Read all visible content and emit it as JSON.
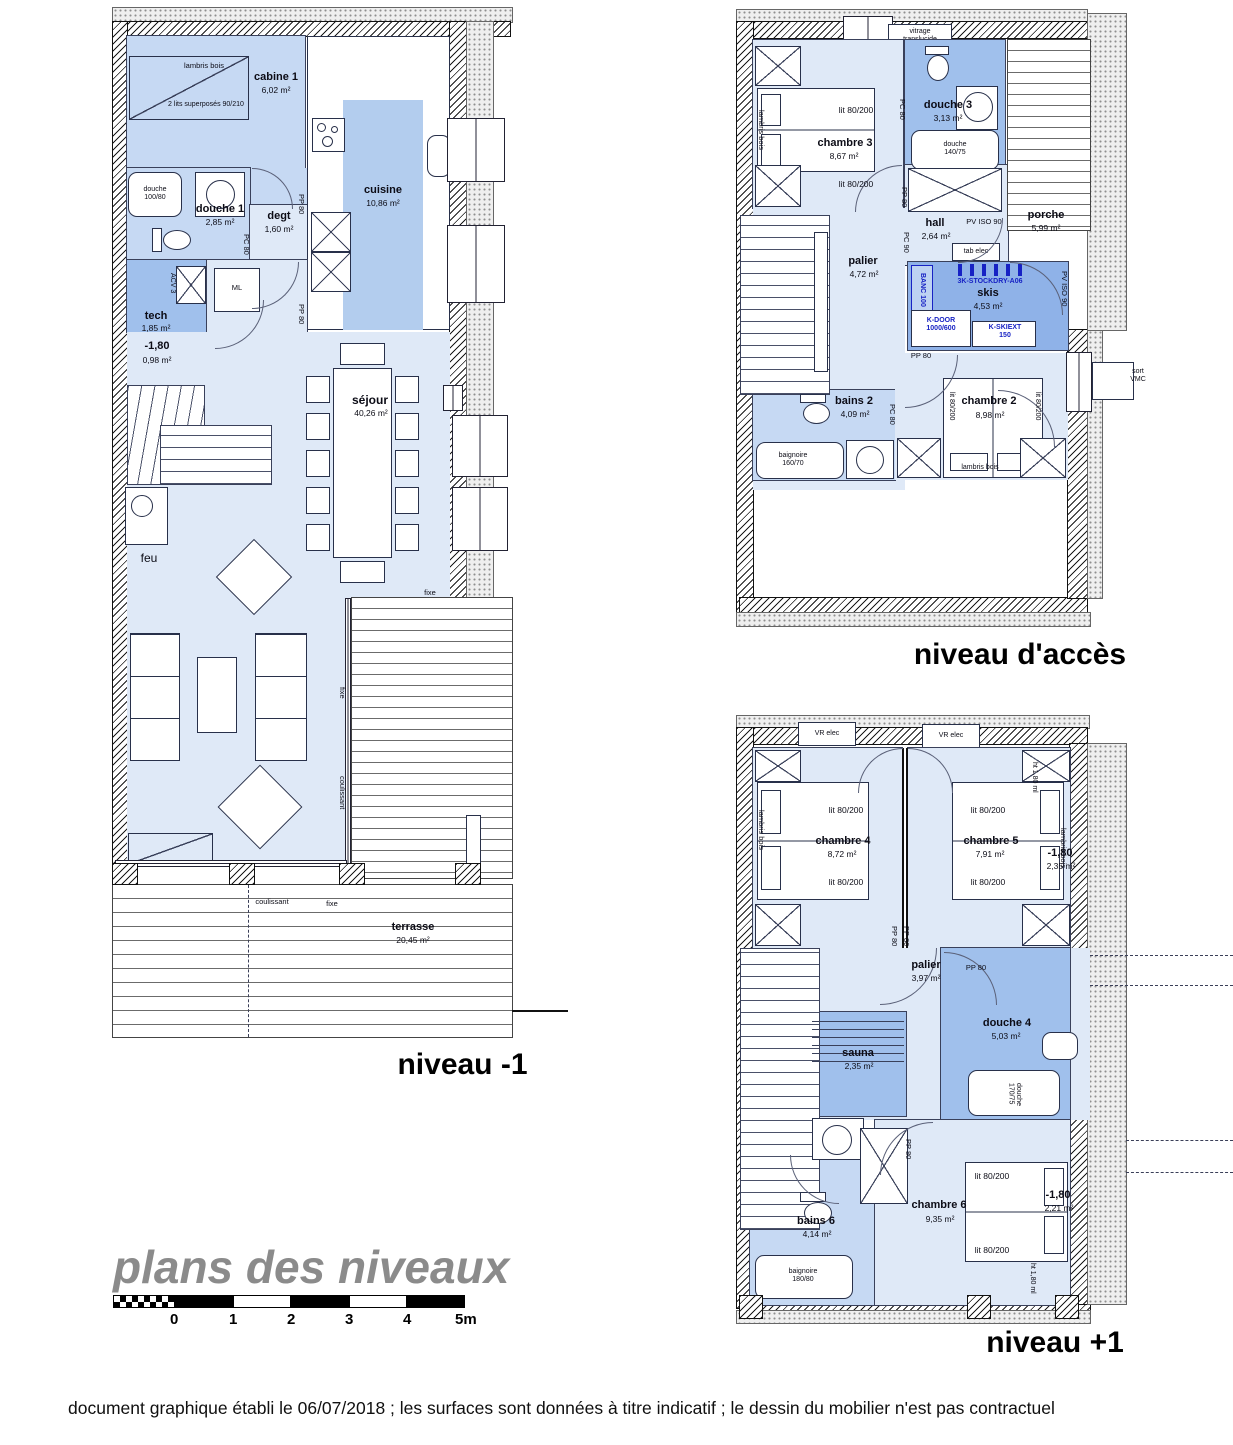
{
  "doc": {
    "title": "plans des niveaux",
    "footer": "document graphique établi le 06/07/2018 ; les surfaces sont données à titre indicatif ; le dessin du mobilier n'est pas contractuel",
    "label_m1": "niveau -1",
    "label_acc": "niveau d'accès",
    "label_p1": "niveau +1"
  },
  "scale": {
    "t": [
      "0",
      "1",
      "2",
      "3",
      "4",
      "5m"
    ]
  },
  "com": {
    "lit": "lit 80/200",
    "lambris": "lambris bois",
    "pp80": "PP 80",
    "pc80": "PC 80",
    "pc90": "PC 90",
    "fixe": "fixe",
    "coul": "coulissant",
    "vr": "VR elec",
    "pv": "PV ISO 90",
    "ht": "ht 1,80 ml",
    "lvl": "-1,80",
    "tab": "tab elec"
  },
  "m1": {
    "cabine1": {
      "name": "cabine 1",
      "area": "6,02 m²"
    },
    "lits_sup": "2 lits superposés 90/210",
    "douche_tray": "douche 100/80",
    "douche1": {
      "name": "douche 1",
      "area": "2,85 m²"
    },
    "degt": {
      "name": "degt",
      "area": "1,60 m²"
    },
    "cuisine": {
      "name": "cuisine",
      "area": "10,86 m²"
    },
    "ml": "ML",
    "acv": "ACV 3",
    "tech": {
      "name": "tech",
      "area": "1,85 m²"
    },
    "niche_area": "0,98 m²",
    "sejour": {
      "name": "séjour",
      "area": "40,26 m²"
    },
    "feu": "feu",
    "terrasse": {
      "name": "terrasse",
      "area": "20,45 m²"
    }
  },
  "acc": {
    "vitrage": "vitrage translucide",
    "chambre3": {
      "name": "chambre 3",
      "area": "8,67 m²"
    },
    "douche3": {
      "name": "douche 3",
      "area": "3,13 m²"
    },
    "douche_tray": "douche 140/75",
    "hall": {
      "name": "hall",
      "area": "2,64 m²"
    },
    "porche": {
      "name": "porche",
      "area": "5,99 m²"
    },
    "palier": {
      "name": "palier",
      "area": "4,72 m²"
    },
    "skis": {
      "name": "skis",
      "area": "4,53 m²"
    },
    "banc": "BANC 100",
    "stockdry": "3K-STOCKDRY-A06",
    "kdoor": "K-DOOR 1000/600",
    "kskiext": "K-SKIEXT 150",
    "sort_vmc": "sort VMC",
    "bains2": {
      "name": "bains 2",
      "area": "4,09 m²"
    },
    "baignoire": "baignoire 160/70",
    "chambre2": {
      "name": "chambre 2",
      "area": "8,98 m²"
    }
  },
  "p1": {
    "chambre4": {
      "name": "chambre 4",
      "area": "8,72 m²"
    },
    "chambre5": {
      "name": "chambre 5",
      "area": "7,91 m²"
    },
    "niche5_area": "2,35 m²",
    "palier": {
      "name": "palier",
      "area": "3,97 m²"
    },
    "sauna": {
      "name": "sauna",
      "area": "2,35 m²"
    },
    "douche4": {
      "name": "douche 4",
      "area": "5,03 m²"
    },
    "douche_tray": "douche 170/75",
    "bains6": {
      "name": "bains 6",
      "area": "4,14 m²"
    },
    "baignoire": "baignoire 180/80",
    "chambre6": {
      "name": "chambre 6",
      "area": "9,35 m²"
    },
    "niche6_area": "2,21 m²"
  }
}
